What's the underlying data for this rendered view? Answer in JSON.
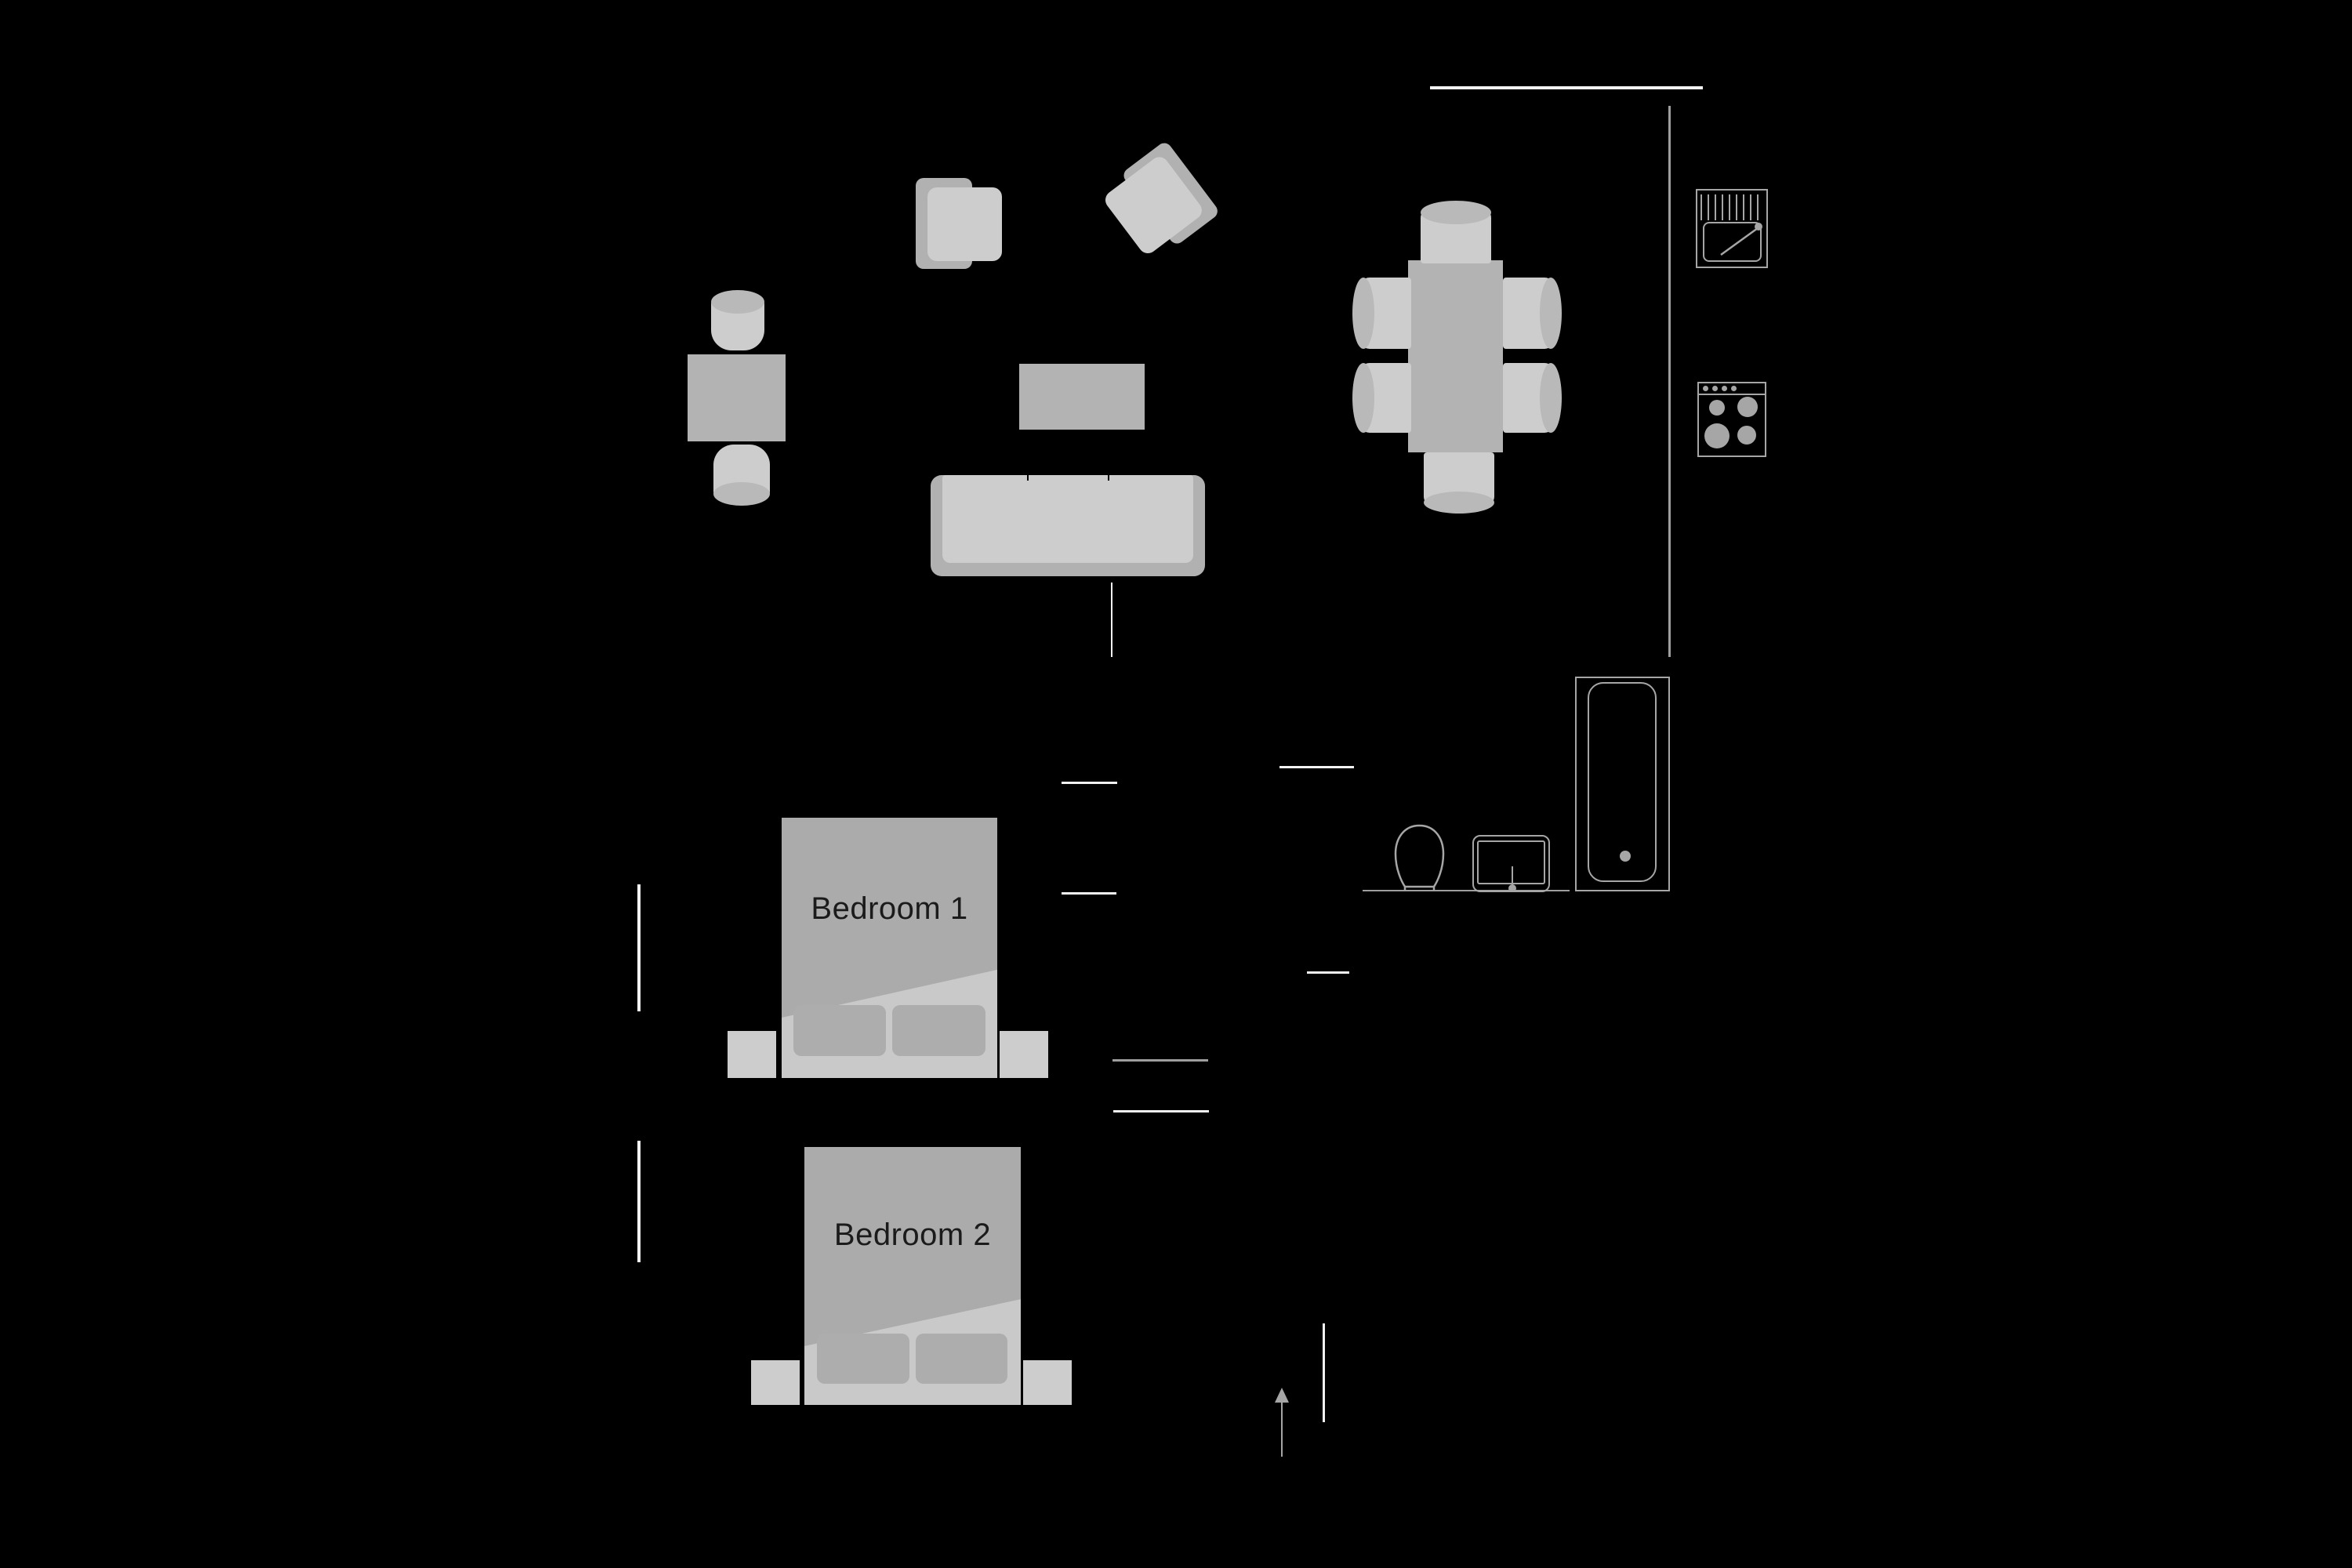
{
  "labels": {
    "bedroom_1": "Bedroom 1",
    "bedroom_2": "Bedroom 2"
  },
  "colors": {
    "background": "#000000",
    "furniture-mid": "#b3b3b3",
    "furniture-light": "#cdcdcd",
    "furniture-frame": "#b1b1b1",
    "cylinder-shade": "#b9b9b9",
    "bed-sheet": "#c9c9c9",
    "bed-duvet": "#ababab",
    "bed-pillow": "#adadad",
    "wall-white": "#f2f2f2",
    "wall-gray": "#9e9e9e",
    "fixture-outline": "#a6a6a6",
    "label-text": "#1b1b1b"
  },
  "rooms": [
    {
      "name": "living-room",
      "furniture": [
        "armchair",
        "armchair",
        "side-table",
        "stool",
        "stool",
        "coffee-table",
        "sofa",
        "floor-lamp"
      ]
    },
    {
      "name": "dining-area",
      "furniture": [
        "dining-table",
        "dining-chair",
        "dining-chair",
        "dining-chair",
        "dining-chair",
        "dining-chair",
        "dining-chair"
      ]
    },
    {
      "name": "kitchen",
      "furniture": [
        "kitchen-sink",
        "stove"
      ]
    },
    {
      "name": "bathroom",
      "furniture": [
        "toilet",
        "washbasin",
        "bathtub"
      ]
    },
    {
      "name": "bedroom-1",
      "label_key": "bedroom_1",
      "furniture": [
        "double-bed",
        "nightstand",
        "nightstand"
      ]
    },
    {
      "name": "bedroom-2",
      "label_key": "bedroom_2",
      "furniture": [
        "double-bed",
        "nightstand",
        "nightstand"
      ]
    }
  ],
  "entrance": {
    "arrow_direction": "up"
  }
}
